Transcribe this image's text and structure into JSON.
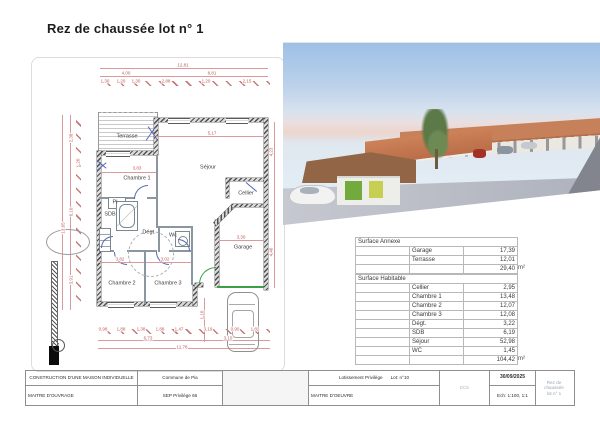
{
  "page": {
    "title": "Rez de chaussée lot n° 1"
  },
  "colors": {
    "dimension_red": "#c25a5a",
    "wall_gray": "#4a4a4a",
    "door_green": "#3aa048",
    "door_blue": "#5868b0",
    "roof_terracotta": "#c07a50"
  },
  "plan": {
    "north_glyph": "↑",
    "rooms": [
      {
        "label": "Terrasse",
        "x": 127,
        "y": 136
      },
      {
        "label": "Chambre 1",
        "x": 137,
        "y": 178
      },
      {
        "label": "Séjour",
        "x": 208,
        "y": 167
      },
      {
        "label": "Cellier",
        "x": 246,
        "y": 193
      },
      {
        "label": "Pl",
        "x": 115,
        "y": 202
      },
      {
        "label": "SDB",
        "x": 110,
        "y": 214
      },
      {
        "label": "Dégt.",
        "x": 149,
        "y": 232
      },
      {
        "label": "Wc",
        "x": 173,
        "y": 235
      },
      {
        "label": "Garage",
        "x": 243,
        "y": 247
      },
      {
        "label": "Chambre 2",
        "x": 122,
        "y": 283
      },
      {
        "label": "Chambre 3",
        "x": 168,
        "y": 283
      }
    ],
    "dimensions": [
      {
        "t": "12,81",
        "x": 183,
        "y": 65
      },
      {
        "t": "4,00",
        "x": 126,
        "y": 73
      },
      {
        "t": "8,81",
        "x": 212,
        "y": 73
      },
      {
        "t": "1,30",
        "x": 105,
        "y": 81
      },
      {
        "t": "1,20",
        "x": 121,
        "y": 81
      },
      {
        "t": "1,30",
        "x": 136,
        "y": 81
      },
      {
        "t": "2,88",
        "x": 166,
        "y": 81
      },
      {
        "t": "1,20",
        "x": 206,
        "y": 81
      },
      {
        "t": "2,15",
        "x": 247,
        "y": 81
      },
      {
        "t": "2,38",
        "x": 71,
        "y": 138,
        "r": -90
      },
      {
        "t": "1,20",
        "x": 78,
        "y": 163,
        "r": -90
      },
      {
        "t": "6,10",
        "x": 71,
        "y": 212,
        "r": -90
      },
      {
        "t": "3,91",
        "x": 71,
        "y": 280,
        "r": -90
      },
      {
        "t": "13,65",
        "x": 63,
        "y": 228,
        "r": -90
      },
      {
        "t": "4,23",
        "x": 271,
        "y": 152,
        "r": -90
      },
      {
        "t": "4,46",
        "x": 271,
        "y": 252,
        "r": -90
      },
      {
        "t": "5,17",
        "x": 212,
        "y": 133
      },
      {
        "t": "3,83",
        "x": 137,
        "y": 168
      },
      {
        "t": "3,30",
        "x": 241,
        "y": 237
      },
      {
        "t": "3,82",
        "x": 120,
        "y": 259
      },
      {
        "t": "3,02",
        "x": 165,
        "y": 259
      },
      {
        "t": "1,10",
        "x": 202,
        "y": 315,
        "r": -90
      },
      {
        "t": "0,98",
        "x": 103,
        "y": 329
      },
      {
        "t": "1,88",
        "x": 121,
        "y": 329
      },
      {
        "t": "1,38",
        "x": 141,
        "y": 329
      },
      {
        "t": "1,88",
        "x": 160,
        "y": 329
      },
      {
        "t": "1,47",
        "x": 179,
        "y": 329
      },
      {
        "t": "3,19",
        "x": 208,
        "y": 329
      },
      {
        "t": "0,90",
        "x": 235,
        "y": 329
      },
      {
        "t": "1,82",
        "x": 255,
        "y": 329
      },
      {
        "t": "6,73",
        "x": 148,
        "y": 338
      },
      {
        "t": "3,10",
        "x": 228,
        "y": 338
      },
      {
        "t": "11,78",
        "x": 182,
        "y": 347
      }
    ]
  },
  "surface_tables": [
    {
      "title": "Surface Annexe",
      "rows": [
        [
          "Garage",
          "17,39"
        ],
        [
          "Terrasse",
          "12,01"
        ]
      ],
      "total": "29,40",
      "unit": "m²"
    },
    {
      "title": "Surface Habitable",
      "rows": [
        [
          "Cellier",
          "2,95"
        ],
        [
          "Chambre 1",
          "13,48"
        ],
        [
          "Chambre 2",
          "12,07"
        ],
        [
          "Chambre 3",
          "12,08"
        ],
        [
          "Dégt.",
          "3,22"
        ],
        [
          "SDB",
          "6,19"
        ],
        [
          "Séjour",
          "52,98"
        ],
        [
          "WC",
          "1,45"
        ]
      ],
      "total": "104,42",
      "unit": "m²"
    }
  ],
  "titleblock": {
    "project": "CONSTRUCTION D'UNE MAISON INDIVIDUELLE",
    "owner_label": "MAITRE D'OUVRAGE",
    "commune": "Commune de Pia",
    "company": "SEP Privilège 66",
    "lotissement": "Lotissement Privilège",
    "lot": "Lot: n°10",
    "moe_label": "MAITRE D'OEUVRE",
    "phase": "DCE",
    "date": "30/09/2025",
    "scale": "Ech: 1:100, 1:1",
    "sheet_line1": "Rez de chaussée",
    "sheet_line2": "lot n° 1"
  }
}
